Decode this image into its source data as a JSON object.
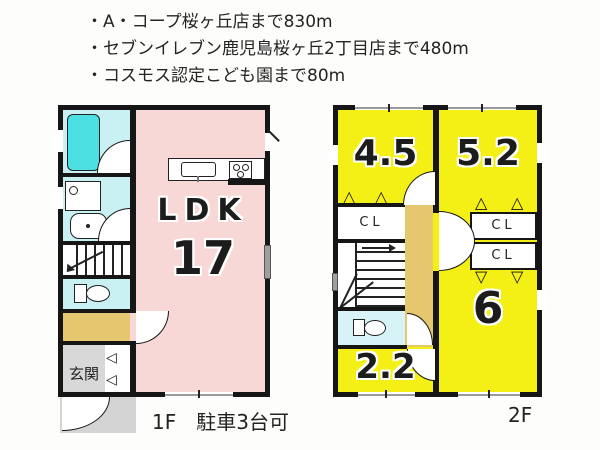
{
  "background": "#fdfdfb",
  "colors": {
    "wall": "#161616",
    "ldk_pink": "#f8d7d7",
    "room_yellow": "#f4ef15",
    "wet_cyan": "#c9f0f2",
    "wet_cyan_light": "#d8f3f8",
    "bathtub_cyan": "#4de0e2",
    "hall_tan": "#e5c76f",
    "entrance_gray": "#d8d8d8",
    "porch_gray": "#d4d4d4",
    "background": "#fdfdfb"
  },
  "info": {
    "lines": [
      "・A・コープ桜ヶ丘店まで830m",
      "・セブンイレブン鹿児島桜ヶ丘2丁目店まで480m",
      "・コスモス認定こども園まで80m"
    ]
  },
  "floor1": {
    "caption": "1F　駐車3台可",
    "ldk_label": "LDK",
    "ldk_size": "17",
    "entrance_label": "玄関"
  },
  "floor2": {
    "caption": "2F",
    "room_tl": "4.5",
    "room_tr": "5.2",
    "room_br": "6",
    "room_bl": "2.2",
    "closet_label": "CL"
  },
  "icons": {
    "fold_door_left": "◁",
    "fold_door_up": "△",
    "fold_door_down": "▽"
  }
}
